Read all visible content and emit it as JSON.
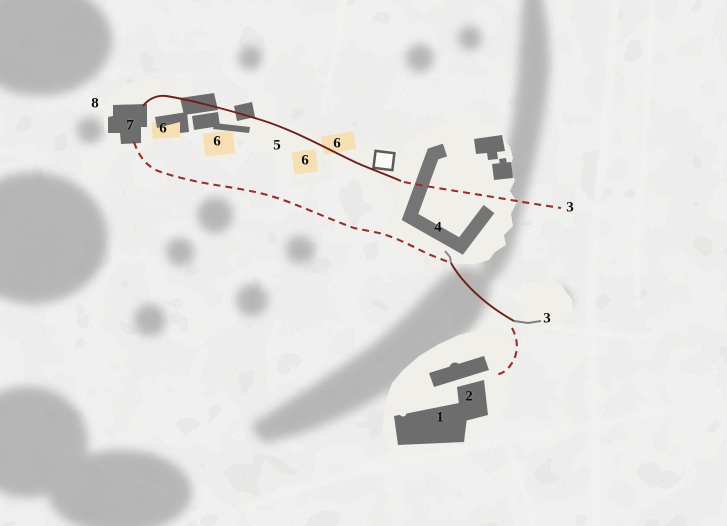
{
  "figure": {
    "title": "aerial-site-plan-with-numbered-areas",
    "labels": [
      {
        "text": "1"
      },
      {
        "text": "2"
      },
      {
        "text": "3"
      },
      {
        "text": "3"
      },
      {
        "text": "4"
      },
      {
        "text": "5"
      },
      {
        "text": "6"
      },
      {
        "text": "6"
      },
      {
        "text": "6"
      },
      {
        "text": "6"
      },
      {
        "text": "7"
      },
      {
        "text": "8"
      }
    ],
    "colors": {
      "photo_base": "#e4e3e1",
      "tree": "#a0a0a0",
      "road": "#f4f4f3",
      "cream": "#f1efe9",
      "tan": "#f7dfb4",
      "bldg": "#6d6d6d",
      "bldg4": "#757575",
      "route_solid": "#701f1c",
      "route_dash": "#96302a",
      "leader": "#7d7d7d",
      "sq_border": "#5a5a5a",
      "label": "#0d0d0d"
    }
  }
}
